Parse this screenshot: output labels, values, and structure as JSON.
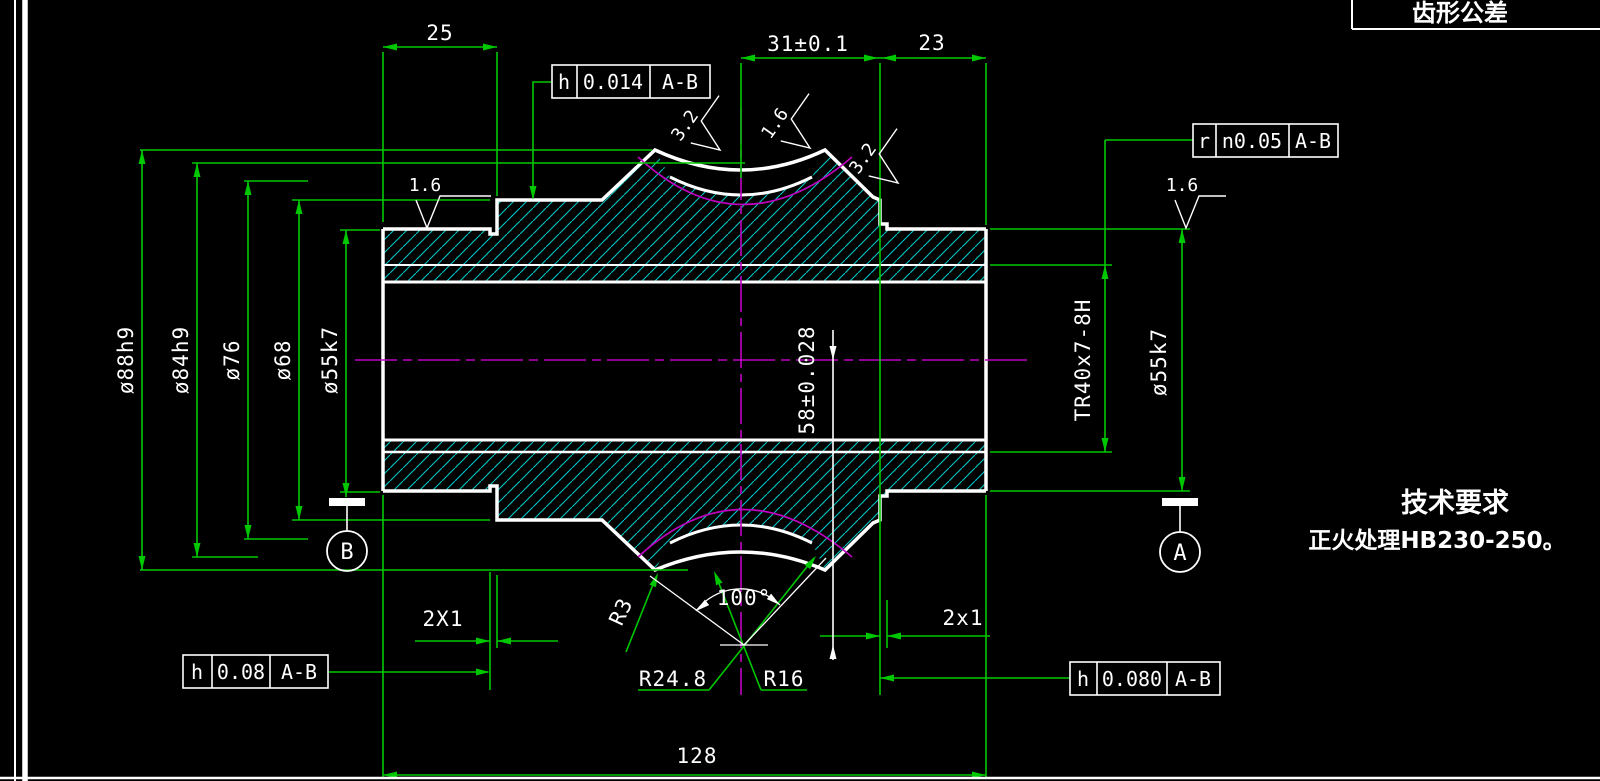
{
  "frame": {
    "tooth_box_label": "齿形公差"
  },
  "notes": {
    "heading": "技术要求",
    "line1": "正火处理HB230-250。"
  },
  "dims": {
    "d25": "25",
    "d31": "31±0.1",
    "d23": "23",
    "d128": "128",
    "dia88": "ø88h9",
    "dia84": "ø84h9",
    "dia76": "ø76",
    "dia68": "ø68",
    "dia55L": "ø55k7",
    "dia55R": "ø55k7",
    "d58": "58±0.028",
    "thread": "TR40x7-8H",
    "grooveL": "2X1",
    "grooveR": "2x1",
    "angle": "100°",
    "r3": "R3",
    "r248": "R24.8",
    "r16": "R16"
  },
  "roughness": {
    "r1": "1.6",
    "r2": "3.2",
    "r3": "1.6",
    "r4": "3.2",
    "r5": "1.6"
  },
  "fcf": {
    "top": {
      "sym": "h",
      "tol": "0.014",
      "datum": "A-B"
    },
    "right": {
      "sym": "r",
      "tol": "n0.05",
      "datum": "A-B"
    },
    "bottom_left": {
      "sym": "h",
      "tol": "0.08",
      "datum": "A-B"
    },
    "bottom_right": {
      "sym": "h",
      "tol": "0.080",
      "datum": "A-B"
    }
  },
  "datums": {
    "b": "B",
    "a": "A"
  },
  "colors": {
    "background": "#000000",
    "dimension_green": "#00c800",
    "outline_white": "#ffffff",
    "centerline_magenta": "#c000c0",
    "hatch_cyan": "#00c8c8"
  }
}
